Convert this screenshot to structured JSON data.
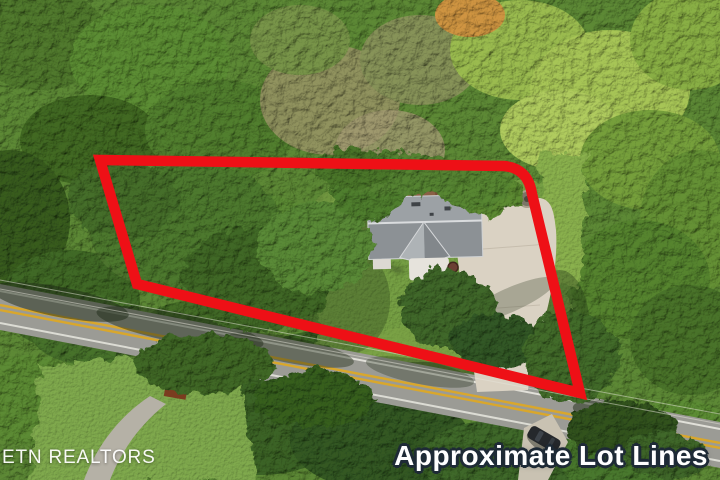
{
  "meta": {
    "type": "aerial-photo",
    "description": "Aerial drone photograph of a wooded residential lot with a gray-roofed house, concrete driveway and a two-lane road; the approximate lot boundary is drawn as a thick red outline."
  },
  "overlays": {
    "watermark": {
      "text": "ETN REALTORS",
      "color": "#ffffff"
    },
    "caption": {
      "text": "Approximate Lot Lines",
      "color": "#ffffff",
      "outline_color": "#1e2a36"
    }
  },
  "lot_boundary": {
    "color": "#ee1016",
    "stroke_width": 10.5,
    "path": "M 100,160 L 504,166 Q 528,168 532,194 L 580,393 L 137,284 Z"
  },
  "scene": {
    "foliage_green": "#567f31",
    "lawn_green": "#6f9840",
    "road_gray": "#9b9b95",
    "road_line_yellow": "#d9a72c",
    "road_edge_white": "#f2f1ea",
    "driveway_concrete": "#dad2c3",
    "house_roof_gray": "#94989b",
    "deck_brown": "#8a6045",
    "car_dark": "#25282c",
    "doghouse_red": "#9c4f2b"
  }
}
